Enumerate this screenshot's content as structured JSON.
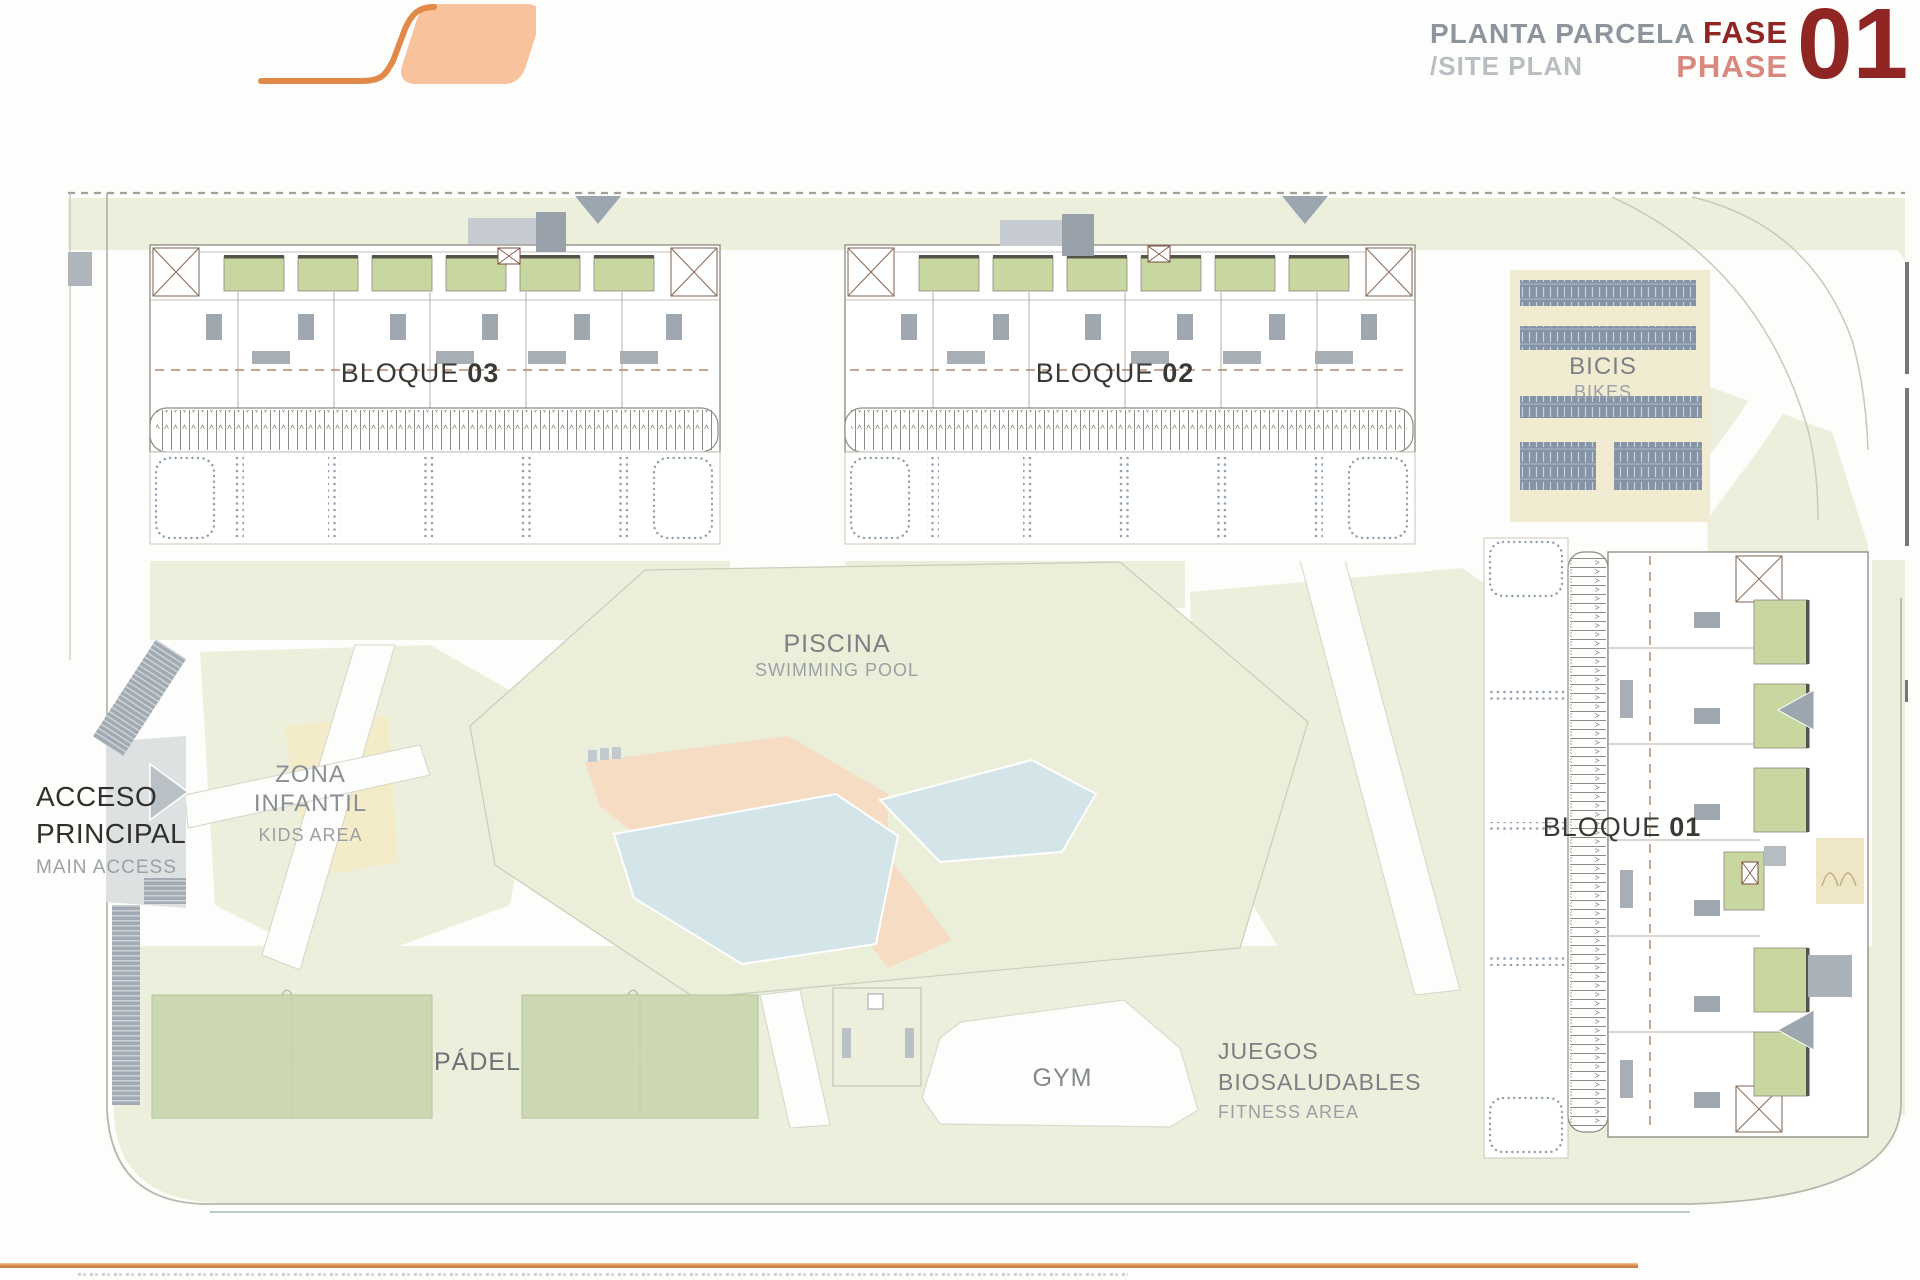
{
  "header": {
    "title_primary": "PLANTA PARCELA",
    "title_secondary": "/SITE PLAN",
    "phase_label_es": "FASE",
    "phase_label_en": "PHASE",
    "phase_number": "01"
  },
  "plan_labels": {
    "bloque03": {
      "name": "BLOQUE",
      "number": "03"
    },
    "bloque02": {
      "name": "BLOQUE",
      "number": "02"
    },
    "bloque01": {
      "name": "BLOQUE",
      "number": "01"
    },
    "bikes": {
      "es": "BICIS",
      "en": "BIKES"
    },
    "pool": {
      "es": "PISCINA",
      "en": "SWIMMING POOL"
    },
    "kids": {
      "es_line1": "ZONA",
      "es_line2": "INFANTIL",
      "en": "KIDS AREA"
    },
    "access": {
      "es_line1": "ACCESO",
      "es_line2": "PRINCIPAL",
      "en": "MAIN ACCESS"
    },
    "padel": {
      "es": "PÁDEL"
    },
    "gym": {
      "es": "GYM"
    },
    "fitness": {
      "es_line1": "JUEGOS",
      "es_line2": "BIOSALUDABLES",
      "en": "FITNESS AREA"
    }
  },
  "colors": {
    "accent_orange": "#E08948",
    "logo_fill": "#F8C29C",
    "phase_dark_red": "#8F2623",
    "phase_salmon": "#D8897F",
    "title_gray": "#8D949B",
    "title_light_gray": "#B9BEC3",
    "green_area": "#ECEFDB",
    "court_green": "#CCD8B2",
    "patio_green": "#C8D7A0",
    "pool_blue": "#D4E5E9",
    "deck_peach": "#F7DCC4",
    "bikes_beige": "#F1EBD2",
    "rack_blue_gray": "#8494A6",
    "label_dark": "#3A3A35",
    "label_gray": "#7B8084"
  }
}
